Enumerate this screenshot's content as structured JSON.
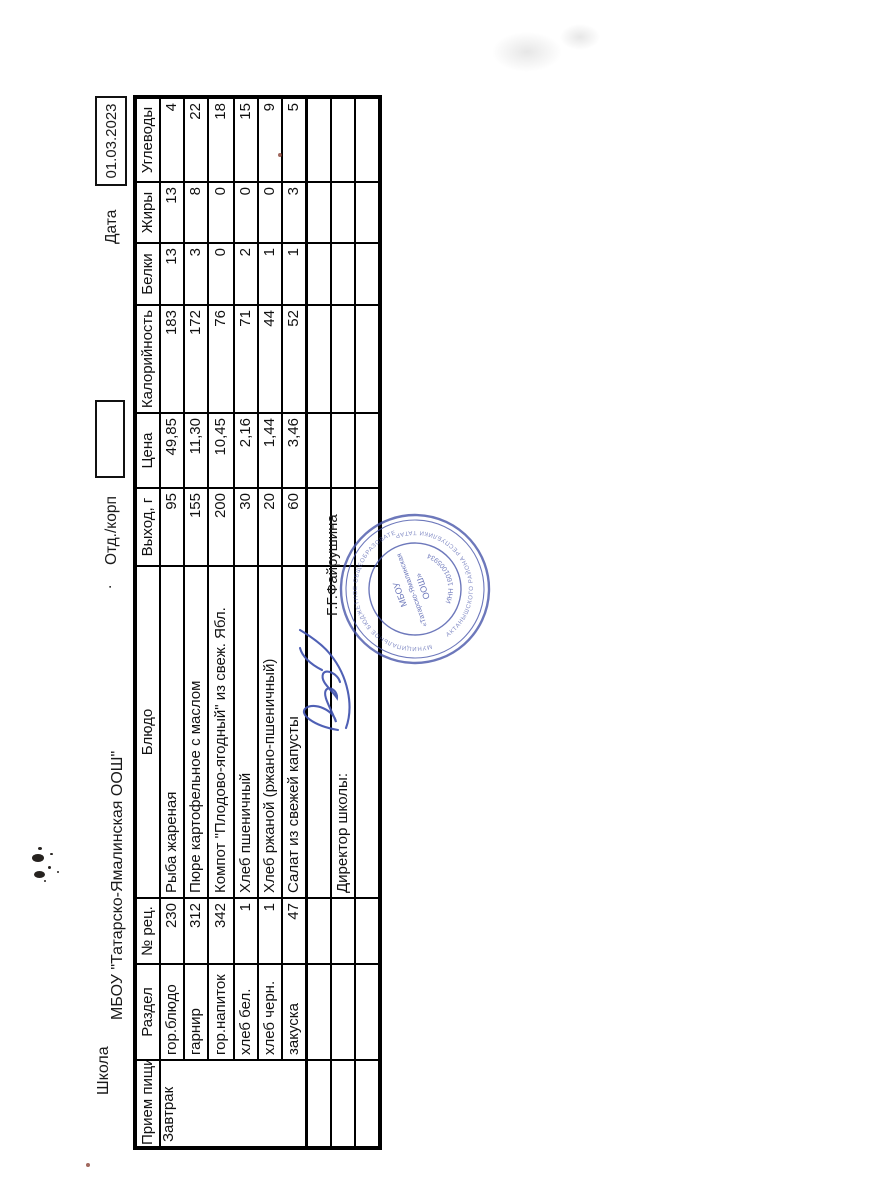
{
  "header": {
    "school_label": "Школа",
    "school_name": "МБОУ \"Татарско-Ямалинская ООШ\"",
    "separator_dot": ".",
    "dept_label": "Отд./корп",
    "dept_value": "",
    "date_label": "Дата",
    "date_value": "01.03.2023"
  },
  "table": {
    "columns": [
      "Прием пищи",
      "Раздел",
      "№ рец.",
      "Блюдо",
      "Выход, г",
      "Цена",
      "Калорийность",
      "Белки",
      "Жиры",
      "Углеводы"
    ],
    "meal": "Завтрак",
    "rows": [
      {
        "razdel": "гор.блюдо",
        "rec": "230",
        "dish": "Рыба жареная",
        "out": "95",
        "price": "49,85",
        "kcal": "183",
        "protein": "13",
        "fat": "13",
        "carbs": "4"
      },
      {
        "razdel": "гарнир",
        "rec": "312",
        "dish": "Пюре картофельное с маслом",
        "out": "155",
        "price": "11,30",
        "kcal": "172",
        "protein": "3",
        "fat": "8",
        "carbs": "22"
      },
      {
        "razdel": "гор.напиток",
        "rec": "342",
        "dish": "Компот \"Плодово-ягодный\" из свеж. Ябл.",
        "out": "200",
        "price": "10,45",
        "kcal": "76",
        "protein": "0",
        "fat": "0",
        "carbs": "18"
      },
      {
        "razdel": "хлеб бел.",
        "rec": "1",
        "dish": "Хлеб пшеничный",
        "out": "30",
        "price": "2,16",
        "kcal": "71",
        "protein": "2",
        "fat": "0",
        "carbs": "15"
      },
      {
        "razdel": "хлеб черн.",
        "rec": "1",
        "dish": "Хлеб ржаной (ржано-пшеничный)",
        "out": "20",
        "price": "1,44",
        "kcal": "44",
        "protein": "1",
        "fat": "0",
        "carbs": "9"
      },
      {
        "razdel": "закуска",
        "rec": "47",
        "dish": "Салат из свежей капусты",
        "out": "60",
        "price": "3,46",
        "kcal": "52",
        "protein": "1",
        "fat": "3",
        "carbs": "5"
      }
    ],
    "footer": {
      "director_label": "Директор школы:",
      "signature_name": "Г.Г.Файрушина"
    }
  },
  "stamp": {
    "ring_text_top": "МУНИЦИПАЛЬНОЕ БЮДЖЕТНОЕ ОБЩЕОБРАЗОВАТЕЛЬНОЕ УЧРЕЖДЕНИЕ",
    "ring_text_bottom": "АКТАНЫШСКОГО РАЙОНА РЕСПУБЛИКИ ТАТАРСТАН",
    "center_line1": "МБОУ",
    "center_line2": "«Татарско-Ямалинская",
    "center_line3": "ООШ»",
    "inn_text": "ИНН 1601005934",
    "color": "#4553a8"
  },
  "ink_color": "#1a1a1a",
  "signature_color": "#3c4fae"
}
